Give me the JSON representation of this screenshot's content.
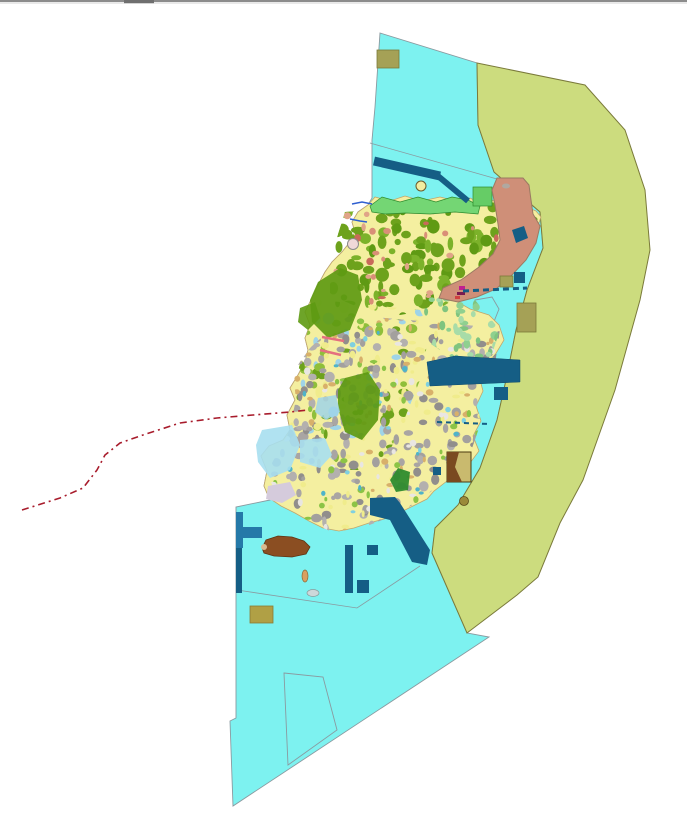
{
  "meta": {
    "description": "GIS land-use / zoning map view of an island with surrounding marine planning zones",
    "canvas": {
      "width": 687,
      "height": 821
    },
    "background": "#ffffff"
  },
  "palette": {
    "sea_cyan": "#7df2f0",
    "zone_olive_band": "#ccdc7e",
    "zone_olive_border": "#7a7a3a",
    "island_base": "#f4efa0",
    "island_border": "#c2a66b",
    "forest_green": "#5e9a12",
    "parcel_green": "#6da21c",
    "coastal_green": "#74d674",
    "salmon_zone": "#cf8f78",
    "salmon_border": "#9a7a62",
    "urban_gray": "#a3a09e",
    "navy_structure": "#155e85",
    "pier_blue": "#2579a8",
    "khaki_plot": "#a5a156",
    "dark_yellow_plot": "#b0a045",
    "brown_area": "#8b4e22",
    "red_dash_route": "#a81c2c",
    "boundary_gray": "#8a9aa0"
  },
  "map": {
    "layers": [
      {
        "id": "window-top-border-line",
        "type": "rect",
        "x": 0,
        "y": 0,
        "w": 687,
        "h": 2,
        "fill": "#8c8c8c"
      },
      {
        "id": "window-top-border-shadow",
        "type": "rect",
        "x": 0,
        "y": 2.6,
        "w": 687,
        "h": 0.8,
        "fill": "#c9c9c9"
      },
      {
        "id": "window-top-handle",
        "type": "rect",
        "x": 124,
        "y": 0,
        "w": 30,
        "h": 3.2,
        "fill": "#6f6f6f"
      },
      {
        "id": "sea-zone-cyan",
        "type": "polygon",
        "points": "380,33 477,63 478,125 494,172 540,212 543,248 527,290 516,330 506,380 497,420 480,468 458,505 435,528 432,553 467,633 489,637 233,806 230,721 236,718 236,507 270,500 269,498 264,486 267,471 261,456 269,446 283,440 290,430 287,415 295,400 290,388 298,375 305,362 308,350 305,338 310,325 305,312 312,298 318,285 325,272 332,262 342,252 350,242 355,232 352,222 358,212 368,205 372,198 372,140 375,107",
        "fill": "#7df2f0",
        "stroke": "#8a9aa0",
        "sw": 0.9
      },
      {
        "id": "zone-olive-band",
        "type": "polygon",
        "points": "477,63 585,85 625,130 645,190 650,250 640,300 615,390 583,480 560,523 538,577 517,595 467,633 432,553 435,528 458,505 480,468 497,420 506,380 516,330 527,290 543,248 540,212 494,172 478,125",
        "fill": "#ccdc7e",
        "stroke": "#7a7a3a",
        "sw": 1
      },
      {
        "id": "sea-internal-boundary-north",
        "type": "line",
        "x1": 370,
        "y1": 143,
        "x2": 497,
        "y2": 179,
        "stroke": "#8a9aa0",
        "sw": 0.8
      },
      {
        "id": "sea-internal-boundary-south",
        "type": "polyline",
        "points": "237,590 357,608 420,566",
        "stroke": "#8a9aa0",
        "sw": 0.8
      },
      {
        "id": "sea-parcel-outline-bottom",
        "type": "polygon",
        "points": "284,673 323,677 337,730 288,765",
        "fill": "none",
        "stroke": "#8a9aa0",
        "sw": 0.9
      },
      {
        "id": "sea-parcel-outline-east",
        "type": "polygon",
        "points": "475,300 492,297 499,309 493,324 476,322",
        "fill": "none",
        "stroke": "#8a9aa0",
        "sw": 0.9
      },
      {
        "id": "sea-parcel-outline-southeast",
        "type": "polygon",
        "points": "432,425 456,420 463,438 438,444",
        "fill": "none",
        "stroke": "#8a9aa0",
        "sw": 0.9
      },
      {
        "id": "island-base",
        "type": "polygon",
        "points": "368,205 375,197 390,201 405,196 422,201 440,197 456,201 470,198 480,203 492,200 503,206 516,203 526,207 536,211 541,217 537,228 528,238 518,252 504,262 489,274 474,284 461,293 456,301 470,309 489,315 499,325 504,340 495,355 486,363 479,376 483,391 476,406 481,421 473,436 479,451 470,463 457,473 447,481 434,491 427,499 413,506 399,513 384,519 369,523 354,528 339,531 323,528 309,521 295,513 281,506 269,498 264,486 267,471 261,456 269,446 283,440 290,430 287,415 295,400 290,388 298,375 305,362 308,350 305,338 310,325 305,312 312,298 318,285 325,272 332,262 342,252 350,242 355,232 352,222 358,212",
        "fill": "#f4efa0",
        "stroke": "#c2a66b",
        "sw": 0.8
      },
      {
        "id": "texture-north-forest-parcels",
        "type": "speckle",
        "clip": "345,212 500,202 540,215 540,235 505,262 470,290 440,308 400,315 360,308 330,295 330,260",
        "bbox": [
          325,
          200,
          220,
          118
        ],
        "seed": 7,
        "count": 170,
        "colors": [
          "#6da21c",
          "#7cb22a",
          "#5f9a14",
          "#6da21c"
        ],
        "rmin": 2.5,
        "rmax": 7
      },
      {
        "id": "texture-north-salmon-spots",
        "type": "speckle",
        "clip": "345,212 500,202 540,215 540,235 505,262 470,290 440,308 400,315 360,308 330,295 330,260",
        "bbox": [
          330,
          205,
          200,
          100
        ],
        "seed": 41,
        "count": 32,
        "colors": [
          "#d98f77",
          "#c96a5a",
          "#e0a488"
        ],
        "rmin": 1.5,
        "rmax": 4
      },
      {
        "id": "texture-midwest-mixed-parcels",
        "type": "speckle",
        "clip": "320,300 420,310 430,330 420,380 400,430 380,470 345,470 310,440 295,400 300,360 308,330",
        "bbox": [
          295,
          300,
          140,
          172
        ],
        "seed": 13,
        "count": 120,
        "colors": [
          "#8fbf3a",
          "#f0ec8c",
          "#6da21c",
          "#9fd4e8"
        ],
        "rmin": 2,
        "rmax": 6
      },
      {
        "id": "texture-south-urban-gray",
        "type": "speckle",
        "clip": "350,315 500,328 495,365 478,385 480,425 468,460 443,482 418,502 392,516 362,528 332,532 304,519 279,502 267,472 288,434 296,400 293,372 310,348 332,328",
        "bbox": [
          267,
          315,
          235,
          218
        ],
        "seed": 11,
        "count": 280,
        "colors": [
          "#a3a09e",
          "#b3b0ae",
          "#918e8c",
          "#a9a5a3"
        ],
        "rmin": 2,
        "rmax": 5.5
      },
      {
        "id": "texture-south-urban-mix",
        "type": "speckle",
        "clip": "350,315 500,328 495,365 478,385 480,425 468,460 443,482 418,502 392,516 362,528 332,532 304,519 279,502 267,472 288,434 296,400 293,372 310,348 332,328",
        "bbox": [
          267,
          315,
          235,
          218
        ],
        "seed": 23,
        "count": 230,
        "colors": [
          "#f0ec8c",
          "#8cc446",
          "#e9e6e2",
          "#d8b06a"
        ],
        "rmin": 1.5,
        "rmax": 4
      },
      {
        "id": "texture-south-teal-dots",
        "type": "speckle",
        "clip": "350,315 500,328 495,365 478,385 480,425 468,460 443,482 418,502 392,516 362,528 332,532 304,519 279,502 267,472 288,434 296,400 293,372 310,348 332,328",
        "bbox": [
          280,
          330,
          210,
          195
        ],
        "seed": 31,
        "count": 30,
        "colors": [
          "#4fb3c9",
          "#7fd0e0"
        ],
        "rmin": 1.5,
        "rmax": 3
      },
      {
        "id": "texture-eastmid-lightgreen",
        "type": "speckle",
        "clip": "420,295 475,300 500,330 490,360 455,360 425,340",
        "bbox": [
          420,
          295,
          80,
          65
        ],
        "seed": 51,
        "count": 42,
        "colors": [
          "#8fd08f",
          "#a8dca8",
          "#7fc47f"
        ],
        "rmin": 2,
        "rmax": 5
      },
      {
        "id": "forest-patch-west-upper",
        "type": "polygon",
        "points": "318,282 340,268 358,275 362,300 350,330 328,338 312,322 310,300",
        "fill": "#5e9a12",
        "opacity": 0.92
      },
      {
        "id": "forest-patch-west-lower",
        "type": "polygon",
        "points": "345,378 368,372 380,390 378,420 362,440 345,432 338,408 338,390",
        "fill": "#5e9a12",
        "opacity": 0.92
      },
      {
        "id": "forest-patch-south-small",
        "type": "polygon",
        "points": "398,468 410,472 408,490 396,492 390,480",
        "fill": "#2e8b2e",
        "opacity": 0.95
      },
      {
        "id": "forest-patch-nw-small",
        "type": "polygon",
        "points": "300,308 315,302 320,318 308,330 298,322",
        "fill": "#5e9a12",
        "opacity": 0.9
      },
      {
        "id": "coastal-green-strip-north",
        "type": "polygon",
        "points": "370,206 382,197 400,202 418,197 436,202 452,197 468,200 480,206 478,214 455,212 430,214 405,213 385,214 372,212",
        "fill": "#74d674",
        "stroke": "#2e8b2e",
        "sw": 0.7
      },
      {
        "id": "green-plot-northeast",
        "type": "rect",
        "x": 473,
        "y": 187,
        "w": 19,
        "h": 19,
        "fill": "#66cc66",
        "stroke": "#2e8b2e",
        "sw": 0.7
      },
      {
        "id": "salmon-coastal-zone",
        "type": "polygon",
        "points": "497,178 523,178 529,185 531,200 533,214 540,226 536,243 526,260 511,276 496,289 477,297 458,302 439,298 443,288 461,280 479,267 493,254 500,240 498,224 495,205 492,190",
        "fill": "#cf8f78",
        "stroke": "#9a7a62",
        "sw": 1
      },
      {
        "id": "salmon-zone-gray-mark",
        "type": "ellipse",
        "cx": 506,
        "cy": 186,
        "rx": 4,
        "ry": 2.5,
        "fill": "#b0a8a0"
      },
      {
        "id": "navy-plot-on-salmon",
        "type": "polygon",
        "points": "512,230 524,226 528,238 516,243",
        "fill": "#155e85"
      },
      {
        "id": "nearshore-blue-west-large",
        "type": "polygon",
        "points": "262,430 292,425 300,445 290,470 270,478 258,462 256,445",
        "fill": "#a7dff0",
        "opacity": 0.9
      },
      {
        "id": "nearshore-blue-west-small",
        "type": "polygon",
        "points": "300,440 325,438 332,455 320,468 300,462",
        "fill": "#a7dff0",
        "opacity": 0.9
      },
      {
        "id": "nearshore-pond-mid",
        "type": "polygon",
        "points": "318,398 336,395 340,412 326,420 315,412",
        "fill": "#9fd4e8",
        "opacity": 0.85
      },
      {
        "id": "lavender-flat-southwest",
        "type": "polygon",
        "points": "268,486 290,482 296,495 282,503 266,499",
        "fill": "#d5cbdc"
      },
      {
        "id": "pink-groyne-upper",
        "type": "line",
        "x1": 322,
        "y1": 337,
        "x2": 344,
        "y2": 341,
        "stroke": "#e4707f",
        "sw": 2.5
      },
      {
        "id": "pink-groyne-lower",
        "type": "line",
        "x1": 320,
        "y1": 350,
        "x2": 341,
        "y2": 355,
        "stroke": "#e4707f",
        "sw": 2.5
      },
      {
        "id": "blue-stream-nw-upper",
        "type": "polyline",
        "points": "352,204 362,202 372,204",
        "stroke": "#2f5fd0",
        "sw": 1.5
      },
      {
        "id": "blue-stream-nw-lower",
        "type": "polyline",
        "points": "350,219 360,221 367,222",
        "stroke": "#2f5fd0",
        "sw": 1.5
      },
      {
        "id": "landmark-circle-north",
        "type": "circle",
        "cx": 421,
        "cy": 186,
        "r": 5,
        "fill": "#f2eda0",
        "stroke": "#6b5a2a",
        "sw": 1
      },
      {
        "id": "landmark-circle-northwest",
        "type": "circle",
        "cx": 353,
        "cy": 244,
        "r": 5.5,
        "fill": "#f0d8d8",
        "stroke": "#8a8a8a",
        "sw": 1
      },
      {
        "id": "magenta-harbor-mark-1",
        "type": "rect",
        "x": 459,
        "y": 286,
        "w": 6,
        "h": 4,
        "fill": "#c02090"
      },
      {
        "id": "magenta-harbor-mark-2",
        "type": "rect",
        "x": 457,
        "y": 292,
        "w": 8,
        "h": 3,
        "fill": "#7a1a50"
      },
      {
        "id": "red-harbor-mark",
        "type": "rect",
        "x": 455,
        "y": 296,
        "w": 5,
        "h": 3,
        "fill": "#d04040"
      },
      {
        "id": "route-dashed-red",
        "type": "polyline",
        "points": "22,510 60,498 83,488 97,470 105,455 120,443 143,435 180,423 217,418 253,415 290,412 308,410",
        "stroke": "#a81c2c",
        "sw": 1.6,
        "dash": "7 4 2 4"
      },
      {
        "id": "navy-breakwater-north-thick",
        "type": "line",
        "x1": 374,
        "y1": 161,
        "x2": 440,
        "y2": 176,
        "stroke": "#155e85",
        "sw": 9
      },
      {
        "id": "navy-breakwater-north-thin",
        "type": "line",
        "x1": 438,
        "y1": 176,
        "x2": 468,
        "y2": 201,
        "stroke": "#155e85",
        "sw": 6
      },
      {
        "id": "navy-dashed-line-east",
        "type": "line",
        "x1": 463,
        "y1": 291,
        "x2": 527,
        "y2": 288,
        "stroke": "#155e85",
        "sw": 3,
        "dash": "6 4"
      },
      {
        "id": "navy-dashed-line-southeast",
        "type": "line",
        "x1": 437,
        "y1": 422,
        "x2": 490,
        "y2": 424,
        "stroke": "#155e85",
        "sw": 2,
        "dash": "5 4"
      },
      {
        "id": "navy-port-band-east",
        "type": "polygon",
        "points": "427,362 455,356 520,360 520,382 452,385 430,386",
        "fill": "#155e85",
        "stroke": "#0e4a6b",
        "sw": 0.5
      },
      {
        "id": "navy-port-block-east-small",
        "type": "rect",
        "x": 494,
        "y": 387,
        "w": 14,
        "h": 13,
        "fill": "#155e85"
      },
      {
        "id": "navy-channel-band-south",
        "type": "polygon",
        "points": "370,498 395,497 400,503 430,550 427,565 412,562 390,520 370,515",
        "fill": "#155e85"
      },
      {
        "id": "navy-pier-T-vertical",
        "type": "rect",
        "x": 236,
        "y": 512,
        "w": 7,
        "h": 36,
        "fill": "#2579a8"
      },
      {
        "id": "navy-pier-T-arm",
        "type": "rect",
        "x": 243,
        "y": 527,
        "w": 19,
        "h": 11,
        "fill": "#2579a8"
      },
      {
        "id": "navy-edge-strip-southwest",
        "type": "rect",
        "x": 236,
        "y": 548,
        "w": 6,
        "h": 45,
        "fill": "#155e85"
      },
      {
        "id": "navy-bar-south",
        "type": "rect",
        "x": 345,
        "y": 545,
        "w": 8,
        "h": 48,
        "fill": "#155e85"
      },
      {
        "id": "navy-square-south-left",
        "type": "rect",
        "x": 357,
        "y": 580,
        "w": 12,
        "h": 13,
        "fill": "#155e85"
      },
      {
        "id": "navy-square-south-upper",
        "type": "rect",
        "x": 367,
        "y": 545,
        "w": 11,
        "h": 10,
        "fill": "#155e85"
      },
      {
        "id": "navy-plot-east-small",
        "type": "rect",
        "x": 514,
        "y": 272,
        "w": 11,
        "h": 11,
        "fill": "#155e85"
      },
      {
        "id": "navy-plot-se-tiny",
        "type": "rect",
        "x": 433,
        "y": 467,
        "w": 8,
        "h": 8,
        "fill": "#155e85"
      },
      {
        "id": "khaki-plot-top",
        "type": "rect",
        "x": 377,
        "y": 50,
        "w": 22,
        "h": 18,
        "fill": "#a5a156",
        "stroke": "#7a7a3a",
        "sw": 0.8
      },
      {
        "id": "khaki-plot-east-large",
        "type": "rect",
        "x": 517,
        "y": 303,
        "w": 19,
        "h": 29,
        "fill": "#a5a156",
        "stroke": "#7a7a3a",
        "sw": 0.8
      },
      {
        "id": "khaki-plot-east-small",
        "type": "rect",
        "x": 500,
        "y": 276,
        "w": 13,
        "h": 11,
        "fill": "#a5a156",
        "stroke": "#7a7a3a",
        "sw": 0.8
      },
      {
        "id": "dark-yellow-plot-bottom",
        "type": "rect",
        "x": 250,
        "y": 606,
        "w": 23,
        "h": 17,
        "fill": "#b0a045",
        "stroke": "#8a7a35",
        "sw": 0.8
      },
      {
        "id": "brown-khaki-plot-southeast",
        "type": "rect",
        "x": 447,
        "y": 452,
        "w": 24,
        "h": 30,
        "fill": "#c9ba6e",
        "stroke": "#4a3a10",
        "sw": 1
      },
      {
        "id": "brown-khaki-plot-wedge",
        "type": "polygon",
        "points": "447,452 459,452 455,467 462,482 447,482",
        "fill": "#7a4a20"
      },
      {
        "id": "olive-dot-southeast",
        "type": "circle",
        "cx": 464,
        "cy": 501,
        "r": 4.5,
        "fill": "#9a8a3a",
        "stroke": "#5a4a1a",
        "sw": 0.8
      },
      {
        "id": "brown-port-area-south",
        "type": "polygon",
        "points": "262,548 266,540 278,536 292,537 304,541 310,547 306,554 292,557 274,556 264,553",
        "fill": "#8b4e22",
        "stroke": "#5f3413",
        "sw": 0.8
      },
      {
        "id": "brown-port-tan-tip",
        "type": "circle",
        "cx": 264,
        "cy": 547,
        "r": 3,
        "fill": "#d9b98f"
      },
      {
        "id": "islet-tan-south",
        "type": "ellipse",
        "cx": 305,
        "cy": 576,
        "rx": 3,
        "ry": 6,
        "fill": "#d9a05f",
        "stroke": "#8a6a3a",
        "sw": 0.7
      },
      {
        "id": "islet-gray-south",
        "type": "ellipse",
        "cx": 313,
        "cy": 593,
        "rx": 6,
        "ry": 3.5,
        "fill": "#ccd8da",
        "stroke": "#8a9a9a",
        "sw": 0.7
      }
    ]
  }
}
